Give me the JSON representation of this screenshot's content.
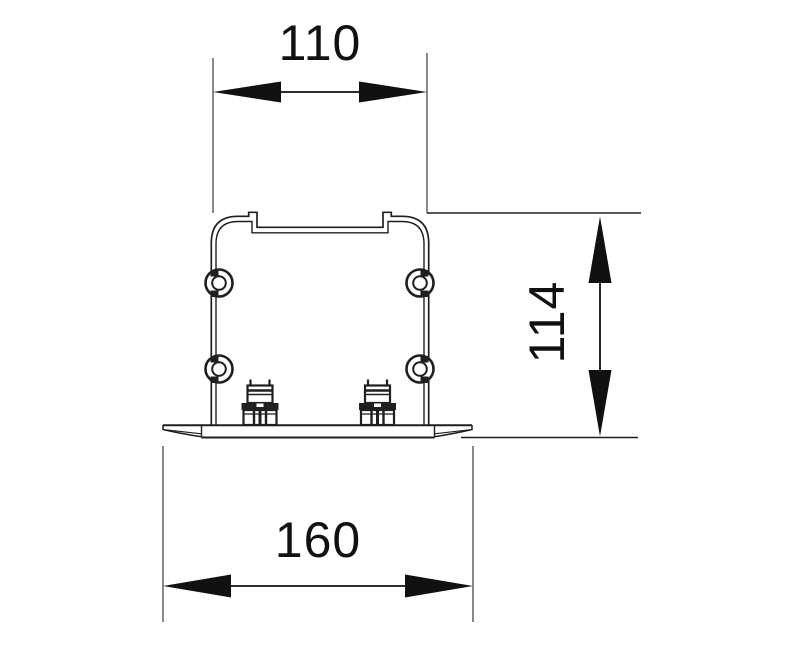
{
  "dimensions": {
    "top_width": "110",
    "side_height": "114",
    "base_width": "160"
  },
  "colors": {
    "background": "#ffffff",
    "line": "#1f1f1f",
    "dimension": "#111111",
    "extension": "#4a4a4a"
  }
}
